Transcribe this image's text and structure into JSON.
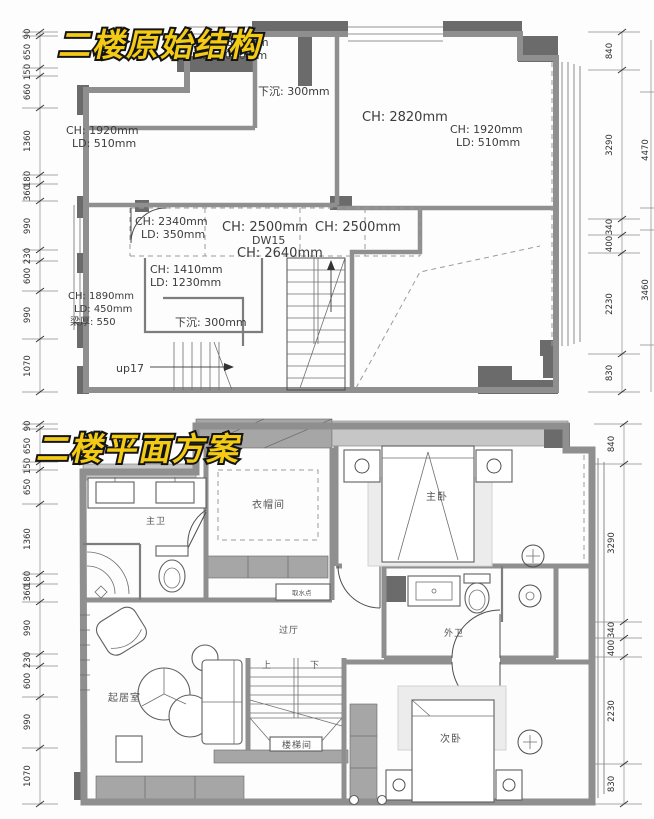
{
  "colors": {
    "title-fill": "#f3cb15",
    "title-stroke": "#141414",
    "wall-dark": "#6b6b6b",
    "wall-gray": "#8f8f8f",
    "wall-mid": "#a6a6a6",
    "line": "#4d4d4d"
  },
  "top_plan": {
    "title": "二楼原始结构",
    "annotations": [
      "CH: 1890mm",
      "LD: 1020mm",
      "下沉: 300mm",
      "CH: 2820mm",
      "CH: 1920mm",
      "LD: 510mm",
      "CH: 1920mm",
      "LD: 510mm",
      "CH: 2340mm",
      "LD: 350mm",
      "CH: 2500mm",
      "CH: 2500mm",
      "DW15",
      "CH: 2640mm",
      "CH: 1410mm",
      "LD: 1230mm",
      "CH: 1890mm",
      "LD: 450mm",
      "梁厚: 550",
      "下沉: 300mm",
      "up17"
    ],
    "dims_left": [
      "90",
      "650",
      "150",
      "660",
      "1360",
      "180",
      "360",
      "990",
      "230",
      "600",
      "990",
      "1070"
    ],
    "dims_right": [
      "840",
      "3290",
      "340",
      "400",
      "2230",
      "830"
    ],
    "dims_far_right": [
      "4470",
      "3460"
    ]
  },
  "bottom_plan": {
    "title": "二楼平面方案",
    "room_labels": [
      "主卫",
      "衣帽间",
      "主卧",
      "外卫",
      "过厅",
      "楼梯间",
      "次卧",
      "起居室",
      "取水点"
    ],
    "stair_labels": [
      "上",
      "下"
    ],
    "dims_left": [
      "90",
      "650",
      "150",
      "650",
      "1360",
      "180",
      "360",
      "990",
      "230",
      "600",
      "990",
      "1070"
    ],
    "dims_right": [
      "840",
      "3290",
      "340",
      "400",
      "2230",
      "830"
    ]
  }
}
